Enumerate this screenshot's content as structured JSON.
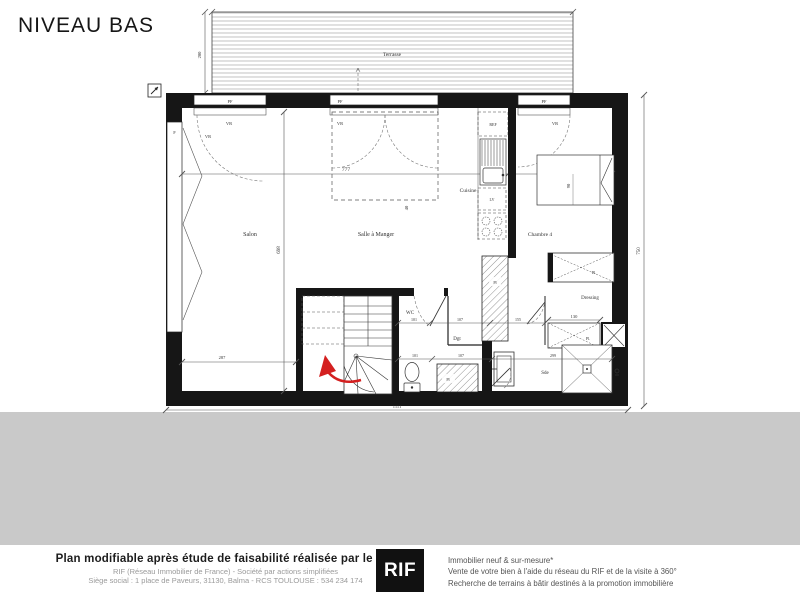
{
  "title": "NIVEAU BAS",
  "plan": {
    "terrace": "Terrasse",
    "rooms": {
      "salon": "Salon",
      "salle_a_manger": "Salle à Manger",
      "cuisine": "Cuisine",
      "chambre4": "Chambre 4",
      "dressing": "Dressing",
      "wc": "WC",
      "dgt": "Dgt",
      "sde": "Sde"
    },
    "fixtures": {
      "pf": "PF",
      "vr": "VR",
      "f": "F",
      "ref": "REF",
      "lv": "LV",
      "pl": "Pl.",
      "pl_short": "Pl"
    },
    "dims": {
      "terrace_height": "200",
      "salon_width": "777",
      "chambre_width": "262",
      "interior_height": "698",
      "right_height": "750",
      "salon_bottom": "287",
      "total_width": "1111",
      "wc_top": "101",
      "dgt_top": "107",
      "hall_top": "155",
      "wc_bottom": "101",
      "dgt_bottom": "107",
      "sde_width": "299",
      "placard_width": "130",
      "bed_width": "90",
      "tremie": "40"
    }
  },
  "footer": {
    "bold_line": "Plan modifiable après étude de faisabilité réalisée par le RIF",
    "legal_line1": "RIF (Réseau Immobilier de France) - Société par actions simplifiées",
    "legal_line2": "Siège social : 1 place de Paveurs, 31130, Balma - RCS TOULOUSE : 534 234 174",
    "logo": "RIF",
    "services": [
      "Immobilier neuf & sur-mesure*",
      "Vente de votre bien à l'aide du réseau du RIF et de la visite à 360°",
      "Recherche de terrains à bâtir destinés à la promotion immobilière"
    ]
  },
  "colors": {
    "wall": "#161616",
    "line": "#555555",
    "accent_red": "#d42020",
    "band_gray": "#c9c9c9"
  }
}
